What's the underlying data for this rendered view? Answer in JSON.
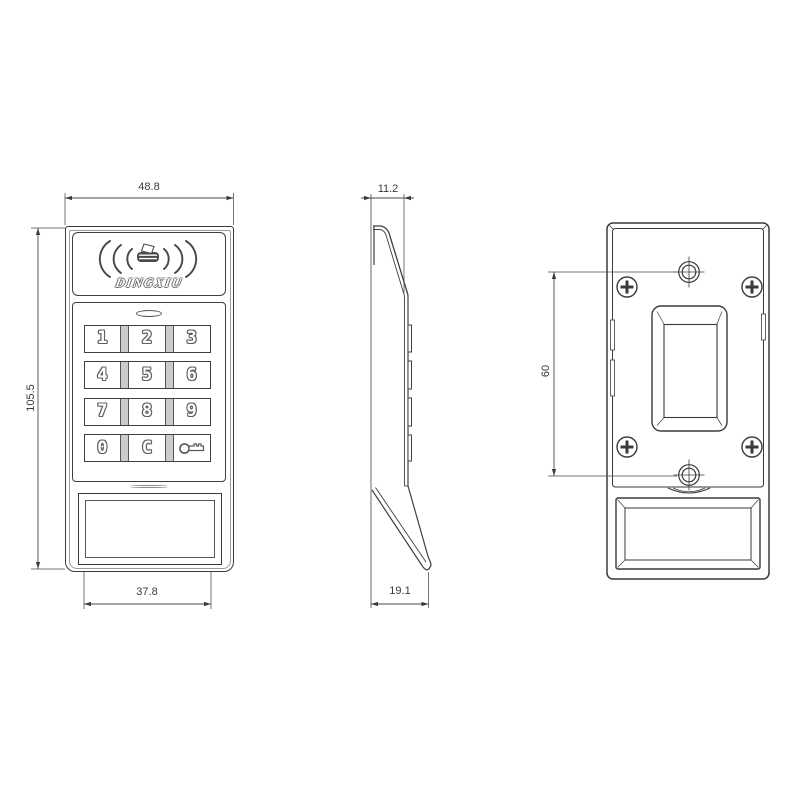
{
  "brand_logo": "DINGXIU",
  "keys": [
    "1",
    "2",
    "3",
    "4",
    "5",
    "6",
    "7",
    "8",
    "9",
    "0",
    "C"
  ],
  "dims": {
    "front_width": "48.8",
    "front_height": "105.5",
    "window_width": "37.8",
    "depth_top": "11.2",
    "depth_bottom": "19.1",
    "mount_hole_spacing": "60"
  },
  "colors": {
    "line": "#3f3f3f",
    "background": "#ffffff"
  }
}
